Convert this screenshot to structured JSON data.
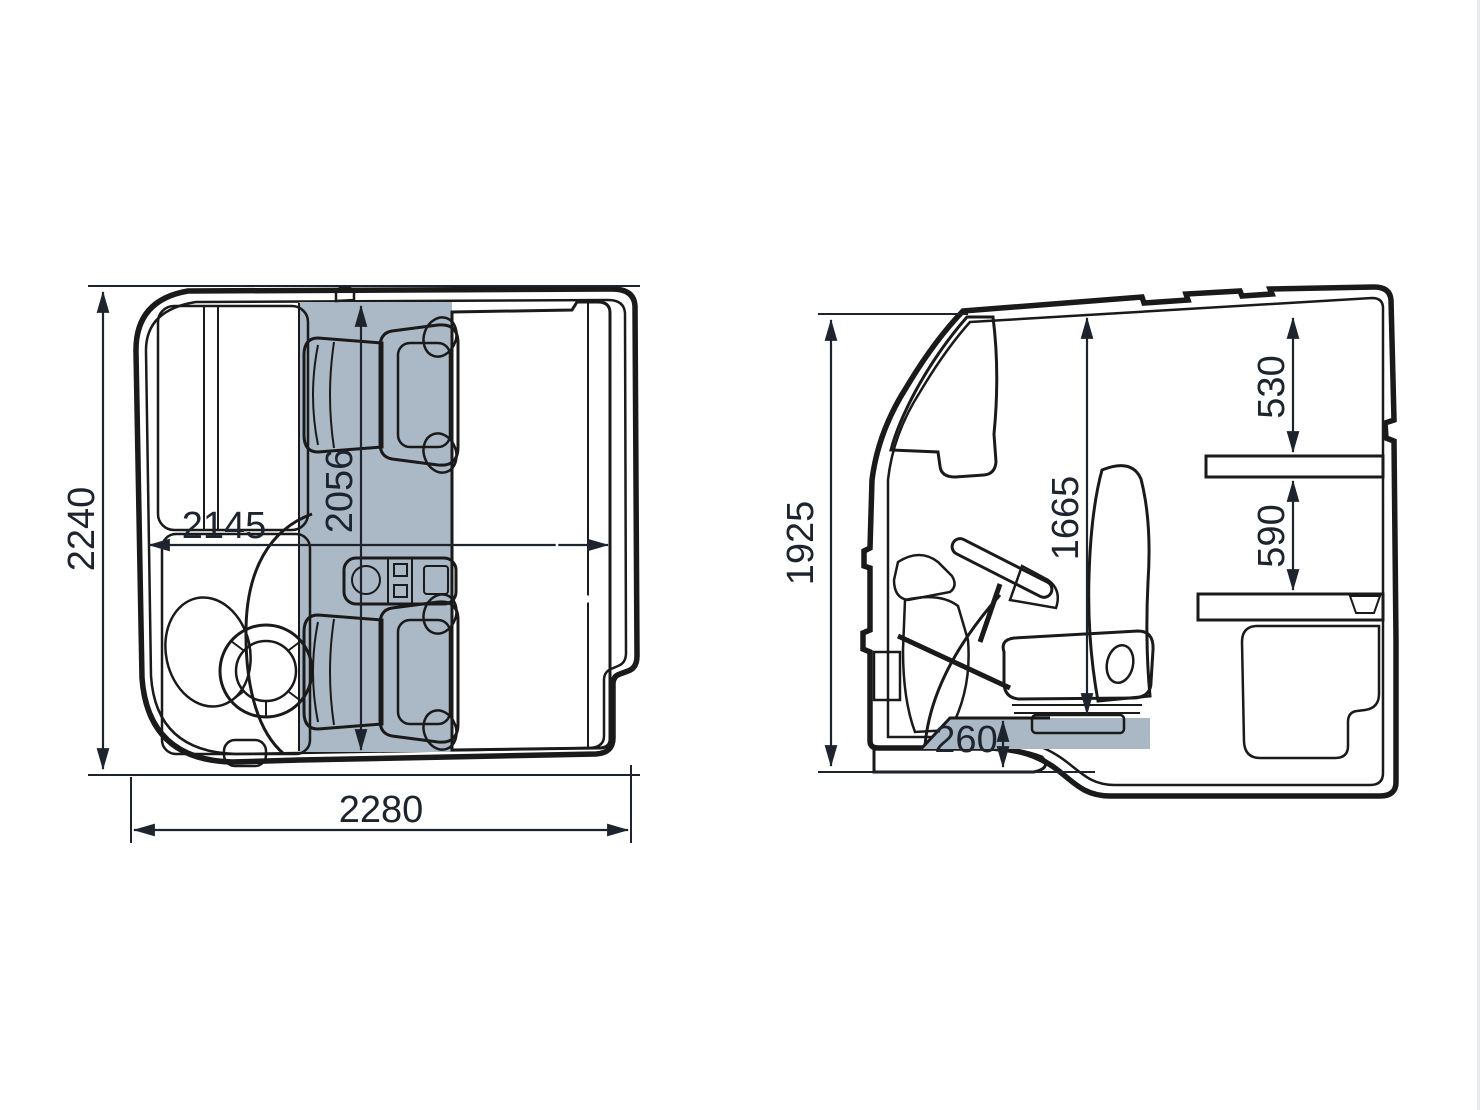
{
  "diagram": {
    "type": "truck-cab-dimension-drawing",
    "views": {
      "top": {
        "label": "cab-top-view",
        "dims": {
          "cab_depth": "2240",
          "interior_width_front": "2145",
          "interior_depth": "2056",
          "bunk_length": "2005",
          "bunk_width": "749",
          "cab_width": "2280"
        }
      },
      "side": {
        "label": "cab-side-view",
        "dims": {
          "cab_height": "1925",
          "interior_height": "1665",
          "roof_to_upper_bunk": "530",
          "upper_to_lower_bunk": "590",
          "engine_tunnel_height": "260"
        }
      }
    },
    "colors": {
      "background": "#ffffff",
      "line": "#1a1a1a",
      "shell": "#d7dadd",
      "interior": "#c6cfd8",
      "interior_strip": "#abb8c6",
      "panel": "#bfcad5",
      "panel_mid": "#a9b6c3",
      "panel_deep": "#93a4b5",
      "dark": "#5e7288",
      "seat_frame": "#8294a7",
      "label_dark": "#1d242e",
      "label_light": "#ffffff"
    }
  }
}
